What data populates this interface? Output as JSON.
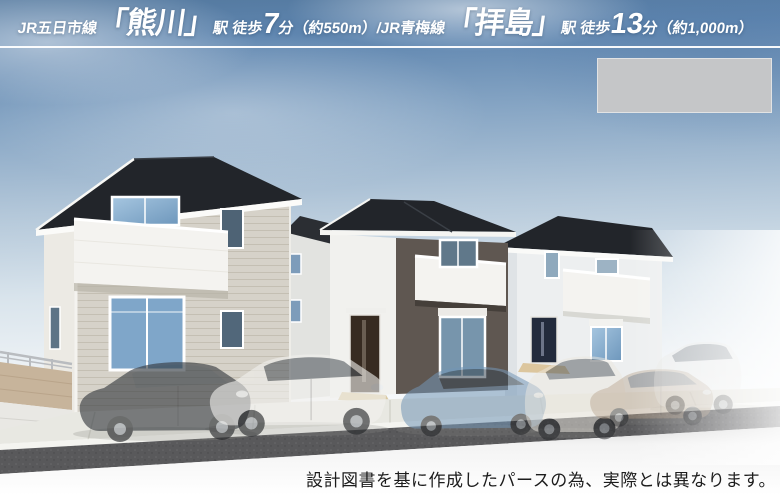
{
  "header": {
    "full_text": "JR五日市線「熊川」駅 徒歩7分（約550m）/JR青梅線「拝島」駅 徒歩13分（約1,000m）",
    "segments": [
      {
        "text": "JR五日市線",
        "style": "small"
      },
      {
        "text": "「熊川」",
        "style": "large"
      },
      {
        "text": "駅 徒歩",
        "style": "small"
      },
      {
        "text": "7",
        "style": "number"
      },
      {
        "text": "分（約550m）/",
        "style": "small"
      },
      {
        "text": "JR青梅線",
        "style": "small"
      },
      {
        "text": "「拝島」",
        "style": "large"
      },
      {
        "text": "駅 徒歩",
        "style": "small"
      },
      {
        "text": "13",
        "style": "number"
      },
      {
        "text": "分（約1,000m）",
        "style": "small"
      }
    ],
    "text_color": "#ffffff"
  },
  "placeholder_box": {
    "color": "#c5c6c8"
  },
  "disclaimer": {
    "text": "設計図書を基に作成したパースの為、実際とは異なります。",
    "color": "#1c1c1c"
  },
  "scene": {
    "description": "3D exterior perspective rendering of three newly built two-story houses with semi-transparent parked cars",
    "palette": {
      "sky_top": "#54799f",
      "roof_dark": "#22252a",
      "house1_wall": "#d6d2c9",
      "house2_wall": "#5f5751",
      "house3_wall": "#edeff0",
      "balcony_white": "#f4f3f0",
      "window_glass": "#7fa6c9",
      "door_brown": "#372b21",
      "door_navy": "#232b3c",
      "fence_beige": "#c7b49b",
      "asphalt": "#59595b",
      "concrete": "#e8e8e2"
    },
    "cars": [
      {
        "name": "dark-gray-sedan",
        "color": "#34383d"
      },
      {
        "name": "white-sedan",
        "color": "#f2f1ee"
      },
      {
        "name": "blue-hatchback",
        "color": "#7396b6"
      },
      {
        "name": "white-minivan",
        "color": "#ece8e0"
      },
      {
        "name": "tan-sedan",
        "color": "#b39d86"
      },
      {
        "name": "white-suv",
        "color": "#e9e7e3"
      }
    ]
  }
}
